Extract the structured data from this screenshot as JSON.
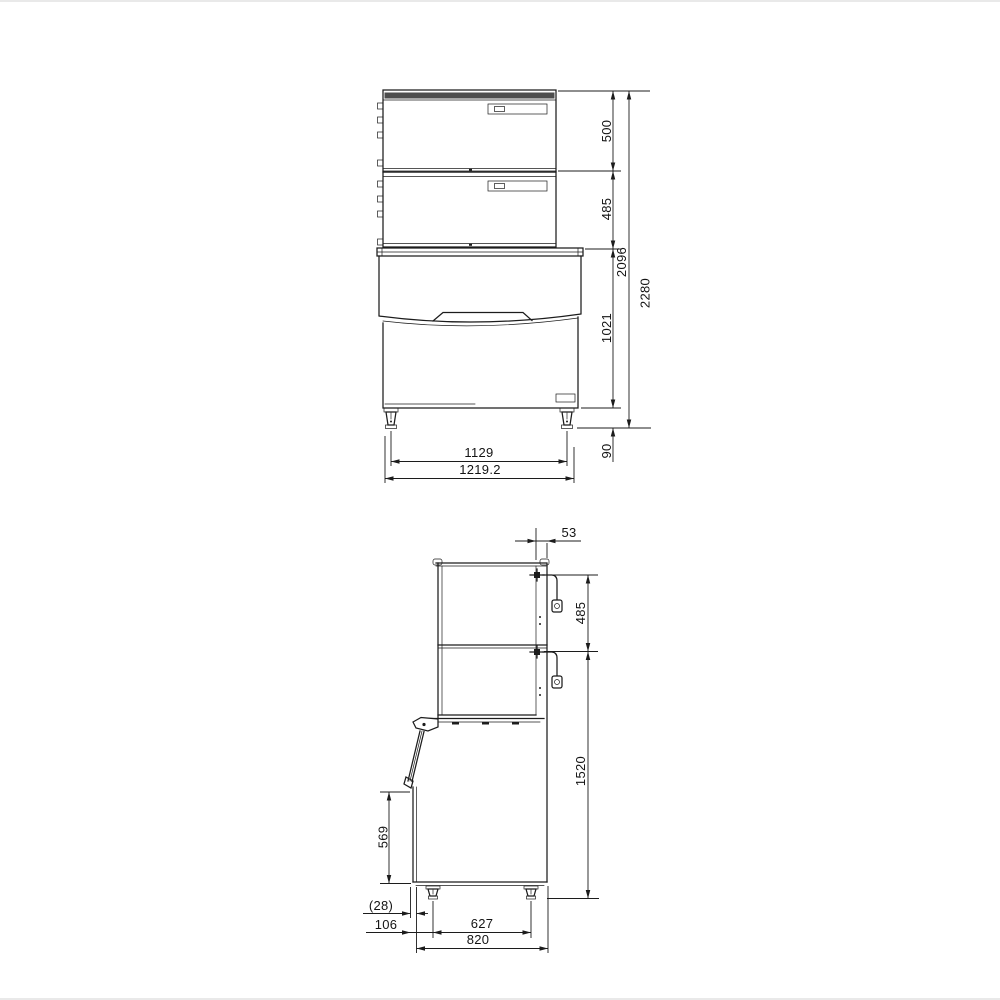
{
  "drawing": {
    "type": "technical-dimension-drawing",
    "views": [
      "front-elevation",
      "side-elevation"
    ],
    "front_view": {
      "dims": {
        "top_unit_height": "500",
        "mid_unit_height": "485",
        "stack_height": "2096",
        "overall_height": "2280",
        "bin_height": "1021",
        "leg_height": "90",
        "leg_span": "1129",
        "overall_width": "1219.2"
      }
    },
    "side_view": {
      "dims": {
        "back_clearance": "53",
        "connector_spacing": "485",
        "connector_height": "1520",
        "door_opening": "569",
        "door_offset": "(28)",
        "front_to_leg": "106",
        "leg_span": "627",
        "overall_depth": "820"
      }
    },
    "colors": {
      "line": "#1c1c1c",
      "louver_band": "#4d4d4d",
      "background": "#ffffff"
    }
  }
}
